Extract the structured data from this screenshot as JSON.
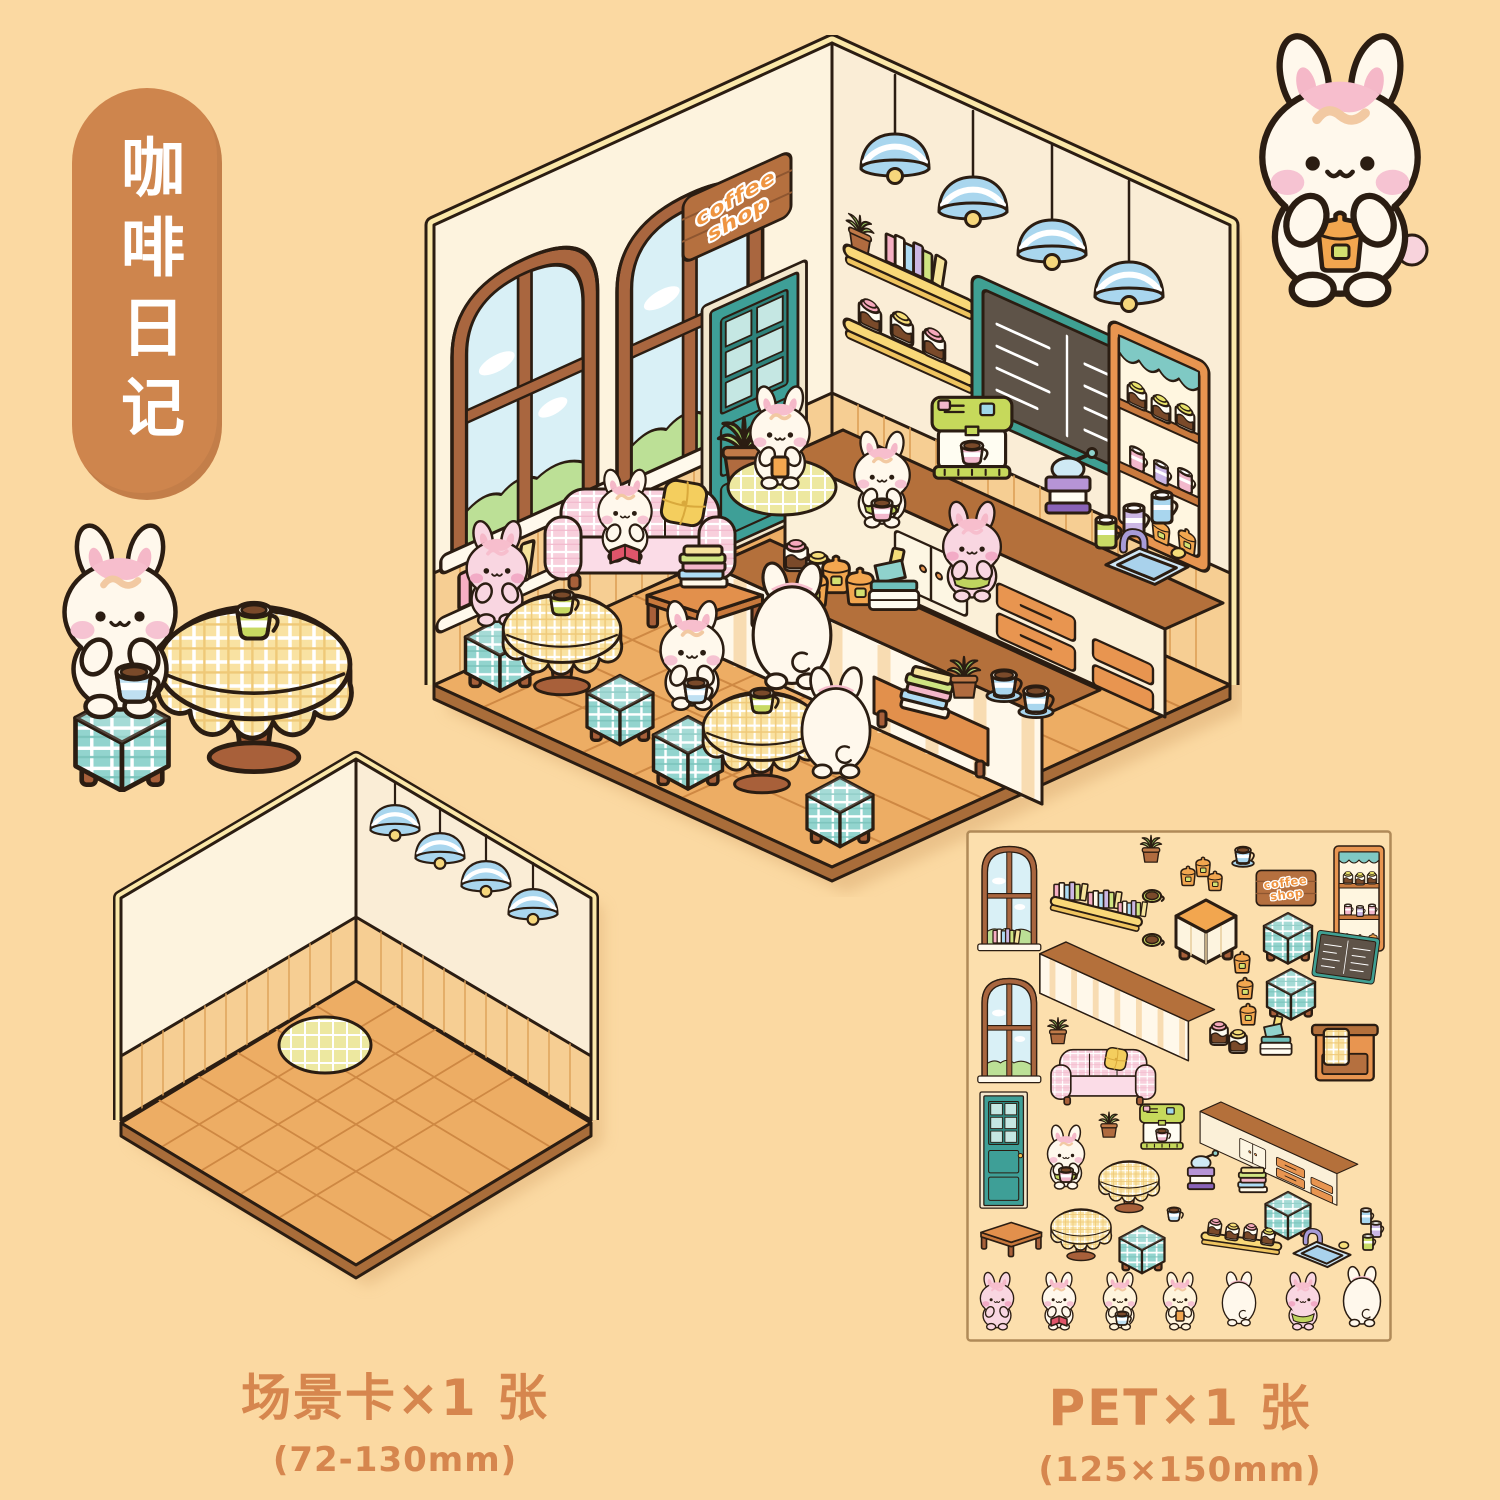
{
  "page": {
    "background": "#FBD9A2",
    "width": 1500,
    "height": 1500
  },
  "title_badge": {
    "text": "咖啡日记",
    "bg_color": "#CE854D",
    "text_color": "#FFFFFF"
  },
  "sign": {
    "line1": "coffee",
    "line2": "shop",
    "text_color": "#EF9440"
  },
  "products": {
    "scene_card": {
      "label": "场景卡×1 张",
      "size": "(72-130mm)"
    },
    "pet_sheet": {
      "label": "PET×1 张",
      "size": "(125×150mm)"
    }
  },
  "palette": {
    "outline": "#2B1D12",
    "caption_text": "#D6864E",
    "wall_cream": "#FDF3DE",
    "wainscot_tan": "#F6CE93",
    "floor_wood": "#EDAD64",
    "trim_yellow": "#FBE8A9",
    "door_teal": "#3E9F97",
    "lamp_blue": "#A9D6EE",
    "sofa_pink": "#F8CFDC",
    "counter_brown": "#B4703B",
    "cabinet_orange": "#E89550",
    "stool_teal": "#92D4CE",
    "tablecloth_yellow": "#F9E2A2",
    "sign_board_brown": "#B5703F",
    "bunny_cream": "#FFF8EC",
    "bunny_pink": "#F9D6E1"
  }
}
